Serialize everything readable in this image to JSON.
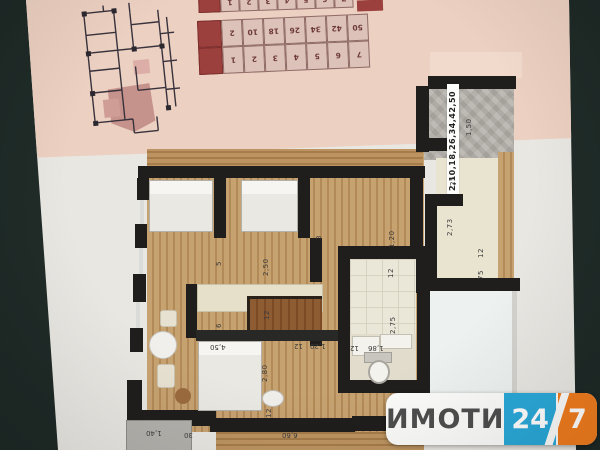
{
  "photo": {
    "subject": "apartment floor plan photo"
  },
  "watermark": {
    "brand": "ИМОТИ",
    "hours": "24",
    "seven": "7",
    "blue": "#2aa8d8",
    "orange": "#f07c1e"
  },
  "tables": {
    "top": {
      "cells": [
        "1",
        "2",
        "3",
        "4",
        "5",
        "6",
        "7"
      ]
    },
    "main": {
      "rows": [
        [
          "2",
          "10",
          "18",
          "26",
          "34",
          "42",
          "50"
        ],
        [
          "1",
          "2",
          "3",
          "4",
          "5",
          "6",
          "7"
        ]
      ]
    }
  },
  "plan": {
    "apartment_numbers": "2,10,18,26,34,42,50",
    "rooms": {
      "r3": "3",
      "r5": "5",
      "r6": "6"
    },
    "dims": {
      "d150": "1,50",
      "d25": "25",
      "d273": "2,73",
      "d75": "75",
      "d12": "12",
      "d120": "1,20",
      "d275": "2,75",
      "d186": "1,86",
      "d250": "2,50",
      "d280": "2,80",
      "d450": "4,50",
      "d140": "1,40",
      "d30": "30",
      "d660": "6,60"
    }
  },
  "colors": {
    "paper_pink": "#ecd0c1",
    "paper_white": "#e9e7e2",
    "wall": "#201e1c",
    "wood": "#c7a271",
    "background": "#222e29"
  }
}
